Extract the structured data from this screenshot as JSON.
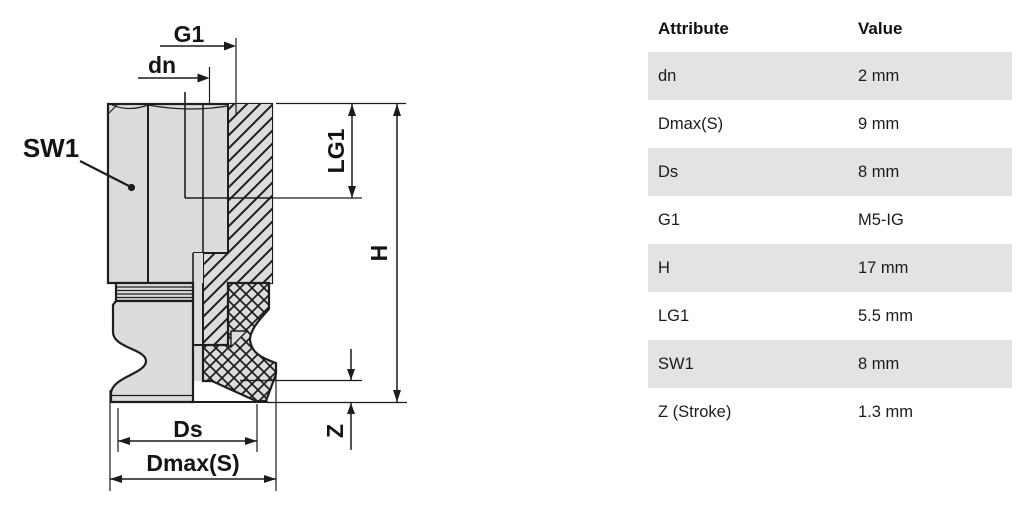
{
  "diagram": {
    "labels": {
      "g1": "G1",
      "dn": "dn",
      "sw1": "SW1",
      "lg1": "LG1",
      "h": "H",
      "z": "Z",
      "ds": "Ds",
      "dmax": "Dmax(S)"
    }
  },
  "table": {
    "headers": {
      "attribute": "Attribute",
      "value": "Value"
    },
    "rows": [
      {
        "attribute": "dn",
        "value": "2 mm"
      },
      {
        "attribute": "Dmax(S)",
        "value": "9 mm"
      },
      {
        "attribute": "Ds",
        "value": "8 mm"
      },
      {
        "attribute": "G1",
        "value": "M5-IG"
      },
      {
        "attribute": "H",
        "value": "17 mm"
      },
      {
        "attribute": "LG1",
        "value": "5.5 mm"
      },
      {
        "attribute": "SW1",
        "value": "8 mm"
      },
      {
        "attribute": "Z (Stroke)",
        "value": "1.3 mm"
      }
    ]
  },
  "colors": {
    "line": "#1e1e1e",
    "part_fill": "#dcdcdc",
    "row_alt": "#e3e3e3",
    "background": "#ffffff"
  }
}
